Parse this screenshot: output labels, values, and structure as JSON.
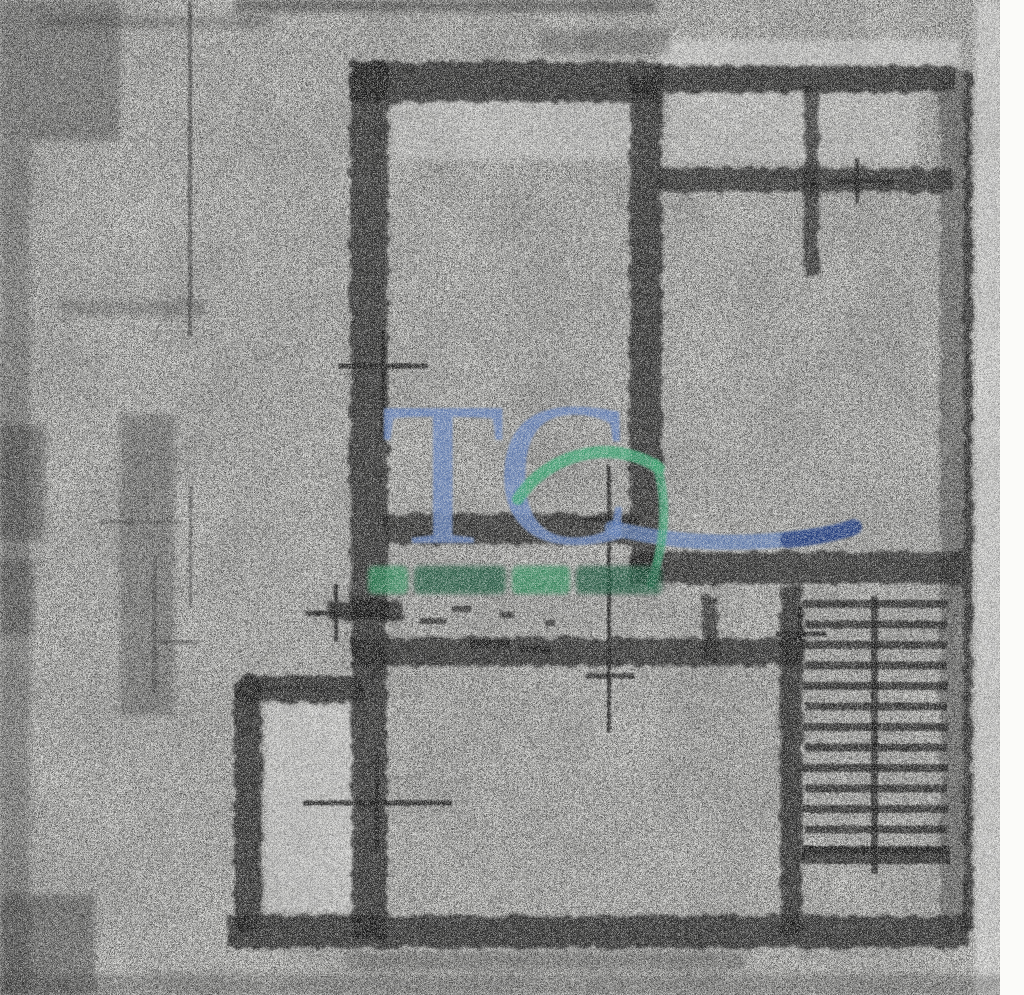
{
  "page": {
    "width": 1024,
    "height": 995,
    "background": "#e8e8e5",
    "margin_color": "#fbfbf9"
  },
  "watermark": {
    "logo_text": "TC",
    "logo_color": "#647fb5",
    "underline_color": "#5d7ab2",
    "underline_dark_color": "#1e3a78",
    "swoosh_color": "#3fa273",
    "subtext_legible": false,
    "subtext_color_a": "#2e8a5a",
    "subtext_color_b": "#145238",
    "subtext_y": 566,
    "subtext_h": 28,
    "subtext_blobs": [
      [
        368,
        40
      ],
      [
        414,
        92
      ],
      [
        512,
        58
      ],
      [
        576,
        86
      ]
    ]
  },
  "plan": {
    "wall_color": "#161616",
    "walls": [
      {
        "name": "outer-top-left-wall",
        "x": 350,
        "y": 62,
        "w": 314,
        "h": 40,
        "o": 0.8
      },
      {
        "name": "outer-top-right-wall",
        "x": 656,
        "y": 66,
        "w": 300,
        "h": 26,
        "o": 0.75
      },
      {
        "name": "outer-left-upper-wall",
        "x": 350,
        "y": 62,
        "w": 38,
        "h": 558,
        "o": 0.78
      },
      {
        "name": "outer-left-lower-wall",
        "x": 352,
        "y": 598,
        "w": 35,
        "h": 342,
        "o": 0.8
      },
      {
        "name": "outer-bottom-wall",
        "x": 228,
        "y": 916,
        "w": 740,
        "h": 32,
        "o": 0.8
      },
      {
        "name": "outer-right-wall-fuzz",
        "x": 940,
        "y": 72,
        "w": 26,
        "h": 860,
        "o": 0.4
      },
      {
        "name": "outer-right-wall-line",
        "x": 964,
        "y": 72,
        "w": 8,
        "h": 862,
        "o": 0.8
      },
      {
        "name": "center-divider-wall",
        "x": 630,
        "y": 76,
        "w": 32,
        "h": 494,
        "o": 0.78
      },
      {
        "name": "topright-room-wall",
        "x": 658,
        "y": 168,
        "w": 294,
        "h": 24,
        "o": 0.72
      },
      {
        "name": "topright-stub-wall",
        "x": 804,
        "y": 84,
        "w": 15,
        "h": 192,
        "o": 0.7
      },
      {
        "name": "mid-wall-left",
        "x": 384,
        "y": 514,
        "w": 252,
        "h": 30,
        "o": 0.78
      },
      {
        "name": "mid-wall-right",
        "x": 630,
        "y": 552,
        "w": 334,
        "h": 32,
        "o": 0.78
      },
      {
        "name": "bath-wall",
        "x": 328,
        "y": 602,
        "w": 74,
        "h": 18,
        "o": 0.75
      },
      {
        "name": "bottomroom-top-wall",
        "x": 352,
        "y": 638,
        "w": 454,
        "h": 28,
        "o": 0.78
      },
      {
        "name": "stair-shaft-wall",
        "x": 780,
        "y": 586,
        "w": 22,
        "h": 350,
        "o": 0.75
      },
      {
        "name": "corridor-stub-wall",
        "x": 702,
        "y": 596,
        "w": 16,
        "h": 64,
        "o": 0.7
      },
      {
        "name": "balcony-top-wall",
        "x": 234,
        "y": 676,
        "w": 130,
        "h": 26,
        "o": 0.75,
        "rx": 10
      },
      {
        "name": "balcony-left-wall",
        "x": 234,
        "y": 676,
        "w": 28,
        "h": 256,
        "o": 0.75,
        "rx": 8
      }
    ],
    "markers": [
      {
        "name": "window-marker-left-room",
        "vx": 383,
        "vy1": 330,
        "vy2": 442,
        "arms": [
          {
            "y": 366,
            "x1": 338,
            "x2": 428
          }
        ]
      },
      {
        "name": "door-axis-marker-center",
        "vx": 609,
        "vy1": 466,
        "vy2": 732,
        "arms": [
          {
            "y": 520,
            "x1": 582,
            "x2": 640
          },
          {
            "y": 676,
            "x1": 586,
            "x2": 634
          }
        ]
      },
      {
        "name": "window-marker-top-right",
        "vx": 857,
        "vy1": 158,
        "vy2": 204,
        "arms": [
          {
            "y": 182,
            "x1": 826,
            "x2": 894
          }
        ]
      },
      {
        "name": "door-marker-balcony",
        "vx": 377,
        "vy1": 754,
        "vy2": 850,
        "arms": [
          {
            "y": 803,
            "x1": 303,
            "x2": 452
          }
        ]
      },
      {
        "name": "window-marker-bath",
        "vx": 336,
        "vy1": 584,
        "vy2": 642,
        "arms": [
          {
            "y": 613,
            "x1": 305,
            "x2": 370
          }
        ]
      },
      {
        "name": "door-marker-stair",
        "vx": 800,
        "vy1": 606,
        "vy2": 660,
        "arms": [
          {
            "y": 634,
            "x1": 776,
            "x2": 826
          }
        ]
      }
    ],
    "dashes": [
      {
        "x": 420,
        "y": 618,
        "w": 26,
        "h": 6
      },
      {
        "x": 452,
        "y": 606,
        "w": 20,
        "h": 6
      },
      {
        "x": 470,
        "y": 640,
        "w": 40,
        "h": 8
      },
      {
        "x": 500,
        "y": 612,
        "w": 14,
        "h": 6
      },
      {
        "x": 520,
        "y": 646,
        "w": 30,
        "h": 7
      },
      {
        "x": 545,
        "y": 620,
        "w": 10,
        "h": 6
      }
    ],
    "stairs": {
      "x": 802,
      "y": 596,
      "w": 148,
      "tread_count": 13,
      "tread_gap": 20.5,
      "tread_h": 8,
      "stringer_x": 871,
      "stringer_w": 7,
      "stringer_h": 278,
      "landing_y": 846,
      "landing_h": 18
    }
  },
  "artifacts": {
    "smudges": [
      {
        "x": 235,
        "y": 0,
        "w": 420,
        "h": 12,
        "o": 0.45
      },
      {
        "x": 40,
        "y": 16,
        "w": 230,
        "h": 12,
        "o": 0.25
      },
      {
        "x": 540,
        "y": 30,
        "w": 130,
        "h": 24,
        "o": 0.3
      },
      {
        "x": 0,
        "y": 0,
        "w": 120,
        "h": 140,
        "o": 0.35
      },
      {
        "x": 0,
        "y": 140,
        "w": 30,
        "h": 855,
        "o": 0.3
      },
      {
        "x": 120,
        "y": 415,
        "w": 55,
        "h": 300,
        "o": 0.3
      },
      {
        "x": 0,
        "y": 425,
        "w": 45,
        "h": 115,
        "o": 0.4
      },
      {
        "x": 0,
        "y": 560,
        "w": 35,
        "h": 75,
        "o": 0.35
      },
      {
        "x": 0,
        "y": 895,
        "w": 95,
        "h": 100,
        "o": 0.4
      },
      {
        "x": 0,
        "y": 975,
        "w": 1024,
        "h": 20,
        "o": 0.25
      },
      {
        "x": 345,
        "y": 952,
        "w": 400,
        "h": 18,
        "o": 0.28
      },
      {
        "x": 60,
        "y": 300,
        "w": 145,
        "h": 16,
        "o": 0.25
      }
    ],
    "highlights": [
      {
        "x": 265,
        "y": 704,
        "w": 94,
        "h": 208,
        "o": 0.3
      },
      {
        "x": 392,
        "y": 96,
        "w": 244,
        "h": 64,
        "o": 0.22
      },
      {
        "x": 668,
        "y": 92,
        "w": 250,
        "h": 70,
        "o": 0.2
      },
      {
        "x": 975,
        "y": 0,
        "w": 28,
        "h": 995,
        "o": 0.35
      },
      {
        "x": 660,
        "y": 40,
        "w": 300,
        "h": 26,
        "o": 0.3
      }
    ],
    "stray_lines": [
      {
        "x": 188,
        "y": 2,
        "w": 4,
        "h": 334,
        "o": 0.55
      },
      {
        "x": 189,
        "y": 486,
        "w": 3,
        "h": 122,
        "o": 0.45
      },
      {
        "x": 152,
        "y": 556,
        "w": 5,
        "h": 138,
        "o": 0.35
      },
      {
        "x": 256,
        "y": 686,
        "w": 80,
        "h": 5,
        "o": 0.5
      },
      {
        "x": 100,
        "y": 520,
        "w": 82,
        "h": 4,
        "o": 0.3
      },
      {
        "x": 160,
        "y": 640,
        "w": 40,
        "h": 4,
        "o": 0.4
      }
    ]
  }
}
